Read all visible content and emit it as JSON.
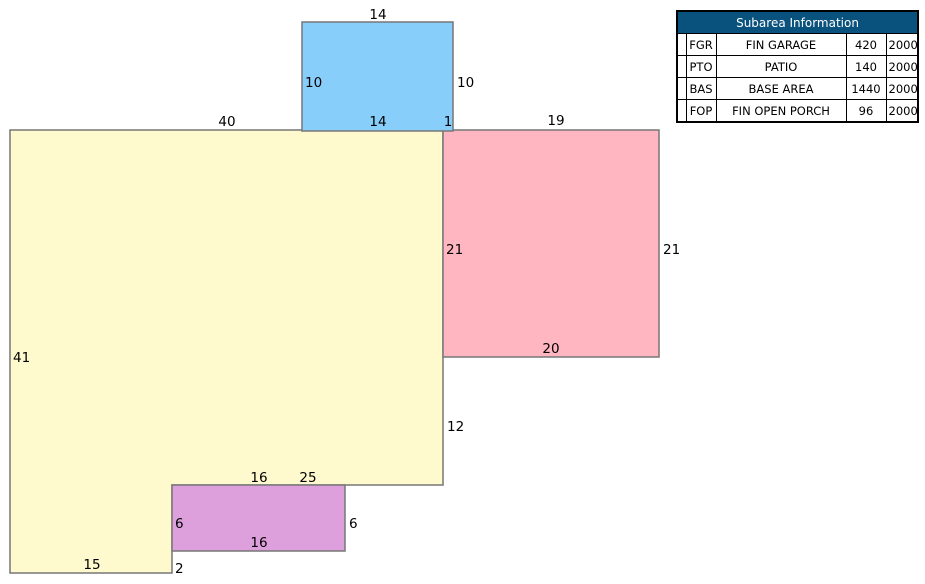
{
  "colors": {
    "header_bg": "#09527E",
    "fgr": "#FFB6C1",
    "pto": "#87CEFA",
    "bas": "#FFFACD",
    "fop": "#DDA0DD"
  },
  "table": {
    "header": "Subarea Information",
    "rows": [
      {
        "code": "FGR",
        "description": "FIN GARAGE",
        "area": "420",
        "year": "2000"
      },
      {
        "code": "PTO",
        "description": "PATIO",
        "area": "140",
        "year": "2000"
      },
      {
        "code": "BAS",
        "description": "BASE AREA",
        "area": "1440",
        "year": "2000"
      },
      {
        "code": "FOP",
        "description": "FIN OPEN PORCH",
        "area": "96",
        "year": "2000"
      }
    ]
  },
  "sketch": {
    "labels": {
      "patio_top": "14",
      "patio_left": "10",
      "patio_right": "10",
      "patio_bottom": "14",
      "patio_overhang": "1",
      "base_top": "40",
      "garage_top": "19",
      "garage_left": "21",
      "garage_right": "21",
      "garage_bottom": "20",
      "base_left": "41",
      "base_right_lower": "12",
      "porch_top": "16",
      "base_step_bottom": "25",
      "porch_left": "6",
      "porch_right": "6",
      "porch_bottom": "16",
      "base_bottom": "15",
      "base_step_right": "2"
    }
  }
}
